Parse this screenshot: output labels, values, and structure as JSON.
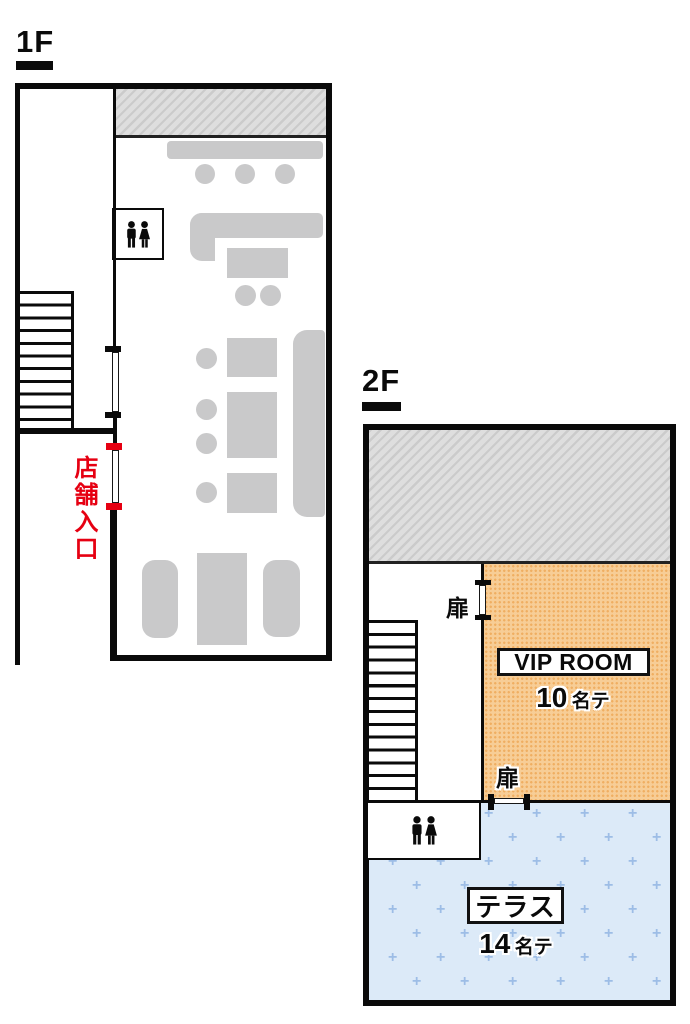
{
  "floor1": {
    "label": "1F",
    "entrance_label": "店舗入口",
    "restroom_icon": "restroom-icon"
  },
  "floor2": {
    "label": "2F",
    "doors": {
      "door1_label": "扉",
      "door2_label": "扉"
    },
    "vip_room": {
      "name": "VIP ROOM",
      "capacity_count": "10",
      "capacity_unit": "名テ"
    },
    "terrace": {
      "name": "テラス",
      "capacity_count": "14",
      "capacity_unit": "名テ"
    },
    "restroom_icon": "restroom-icon",
    "terrace_pattern_mark": "+"
  },
  "colors": {
    "wall_black": "#0a0a0a",
    "entrance_red": "#e60012",
    "vip_orange": "#f7cd96",
    "vip_orange_dot": "#efae62",
    "terrace_blue": "#dceaf8",
    "terrace_plus_blue": "#9dbde6",
    "furniture_gray": "#c9c9ca",
    "hatch_gray": "#dedede",
    "hatch_line_gray": "#cbcbcb"
  }
}
